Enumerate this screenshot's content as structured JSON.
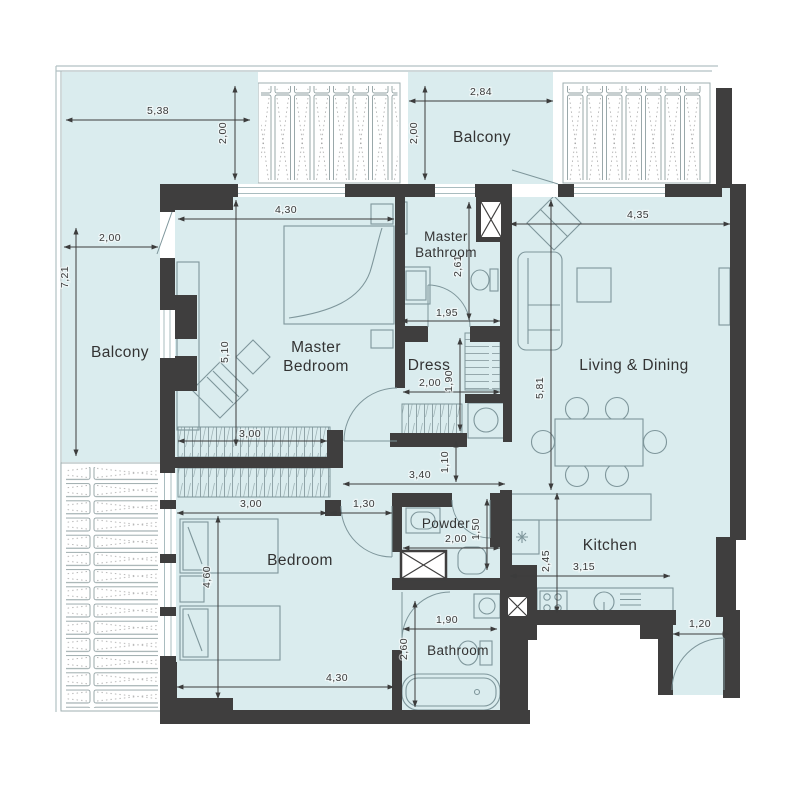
{
  "plan": {
    "rooms": {
      "balcony_left": "Balcony",
      "balcony_top": "Balcony",
      "master_bedroom_line1": "Master",
      "master_bedroom_line2": "Bedroom",
      "master_bathroom_line1": "Master",
      "master_bathroom_line2": "Bathroom",
      "dress": "Dress",
      "living_dining": "Living & Dining",
      "kitchen": "Kitchen",
      "powder": "Powder",
      "bedroom": "Bedroom",
      "bathroom": "Bathroom"
    },
    "dims": {
      "balcony_top_left_w": "5,38",
      "balcony_top_left_d": "2,00",
      "balcony_left_w": "2,00",
      "balcony_left_h": "7,21",
      "balcony_top_w": "2,84",
      "balcony_top_d": "2,00",
      "master_bedroom_w": "4,30",
      "master_bedroom_h": "5,10",
      "master_bathroom_h": "2,61",
      "master_bathroom_w": "1,95",
      "dress_w": "2,00",
      "dress_h": "1,90",
      "living_w": "4,35",
      "living_h": "5,81",
      "hall_w": "3,40",
      "hall_h": "1,10",
      "master_wardrobe_w": "3,00",
      "bedroom_wardrobe_w": "3,00",
      "bedroom_door_w": "1,30",
      "bedroom_h": "4,60",
      "bedroom_w": "4,30",
      "powder_w": "2,00",
      "powder_h": "1,50",
      "kitchen_h": "2,45",
      "kitchen_w": "3,15",
      "bathroom_w": "1,90",
      "bathroom_h": "2,60",
      "entry_w": "1,20"
    },
    "colors": {
      "floor": "#DAECEE",
      "wall": "#3F3E3E",
      "dimension": "#3A3A3A",
      "furniture": "#7E969B",
      "rail": "#B2C1C3"
    }
  }
}
